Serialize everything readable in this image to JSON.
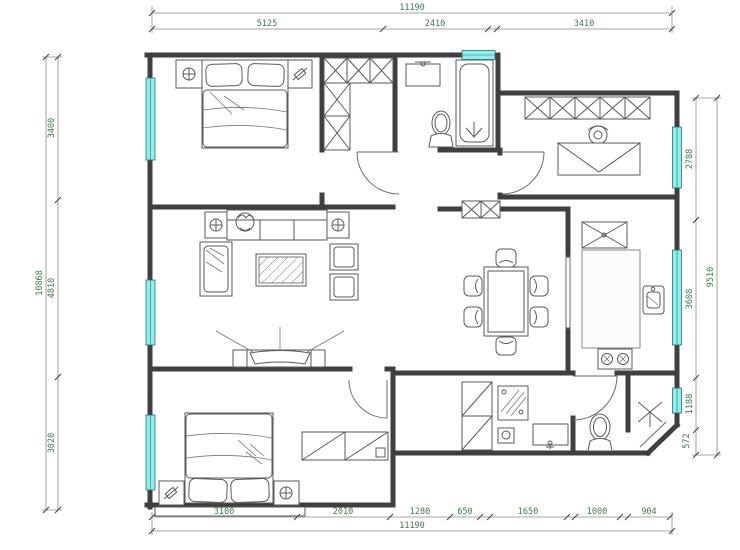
{
  "meta": {
    "drawing_type": "apartment-floor-plan",
    "units": "mm"
  },
  "palette": {
    "wall": "#3f3f3f",
    "window": "#8df0ee",
    "dimension_text": "#3c7a50",
    "furniture_line": "#5a5a5a",
    "background": "#ffffff"
  },
  "dimensions": {
    "top": {
      "overall": "11190",
      "segments": [
        "5125",
        "2410",
        "3410"
      ]
    },
    "bottom": {
      "overall": "11190",
      "segments": [
        "3100",
        "2010",
        "1280",
        "650",
        "1650",
        "1000",
        "904"
      ]
    },
    "left": {
      "overall": "10868",
      "segments": [
        "3400",
        "4810",
        "3020"
      ]
    },
    "right": {
      "overall": "9510",
      "segments": [
        "2788",
        "3608",
        "1188",
        "572"
      ]
    }
  },
  "fixtures": {
    "bedroom_master": [
      "double-bed",
      "nightstand-left",
      "nightstand-right",
      "window"
    ],
    "entry": [
      "l-shaped-wardrobe",
      "shoe-cabinet"
    ],
    "bathroom_top": [
      "wash-basin",
      "toilet",
      "bathtub",
      "window"
    ],
    "study": [
      "wall-cabinet",
      "desk",
      "chair",
      "window"
    ],
    "living_room": [
      "sofa",
      "side-tables",
      "armchairs",
      "chaise",
      "coffee-table",
      "tv-cabinet",
      "tv"
    ],
    "dining_room": [
      "dining-table",
      "six-chairs"
    ],
    "kitchen": [
      "fridge-cabinet",
      "counter",
      "sink",
      "stove",
      "window"
    ],
    "laundry": [
      "tall-cabinet",
      "washing-machine",
      "floor-drain",
      "wash-basin"
    ],
    "bathroom_bottom": [
      "toilet",
      "shower",
      "window"
    ],
    "bedroom_second": [
      "double-bed",
      "nightstand-left",
      "nightstand-right",
      "wardrobe",
      "window",
      "bay-ledge"
    ]
  }
}
